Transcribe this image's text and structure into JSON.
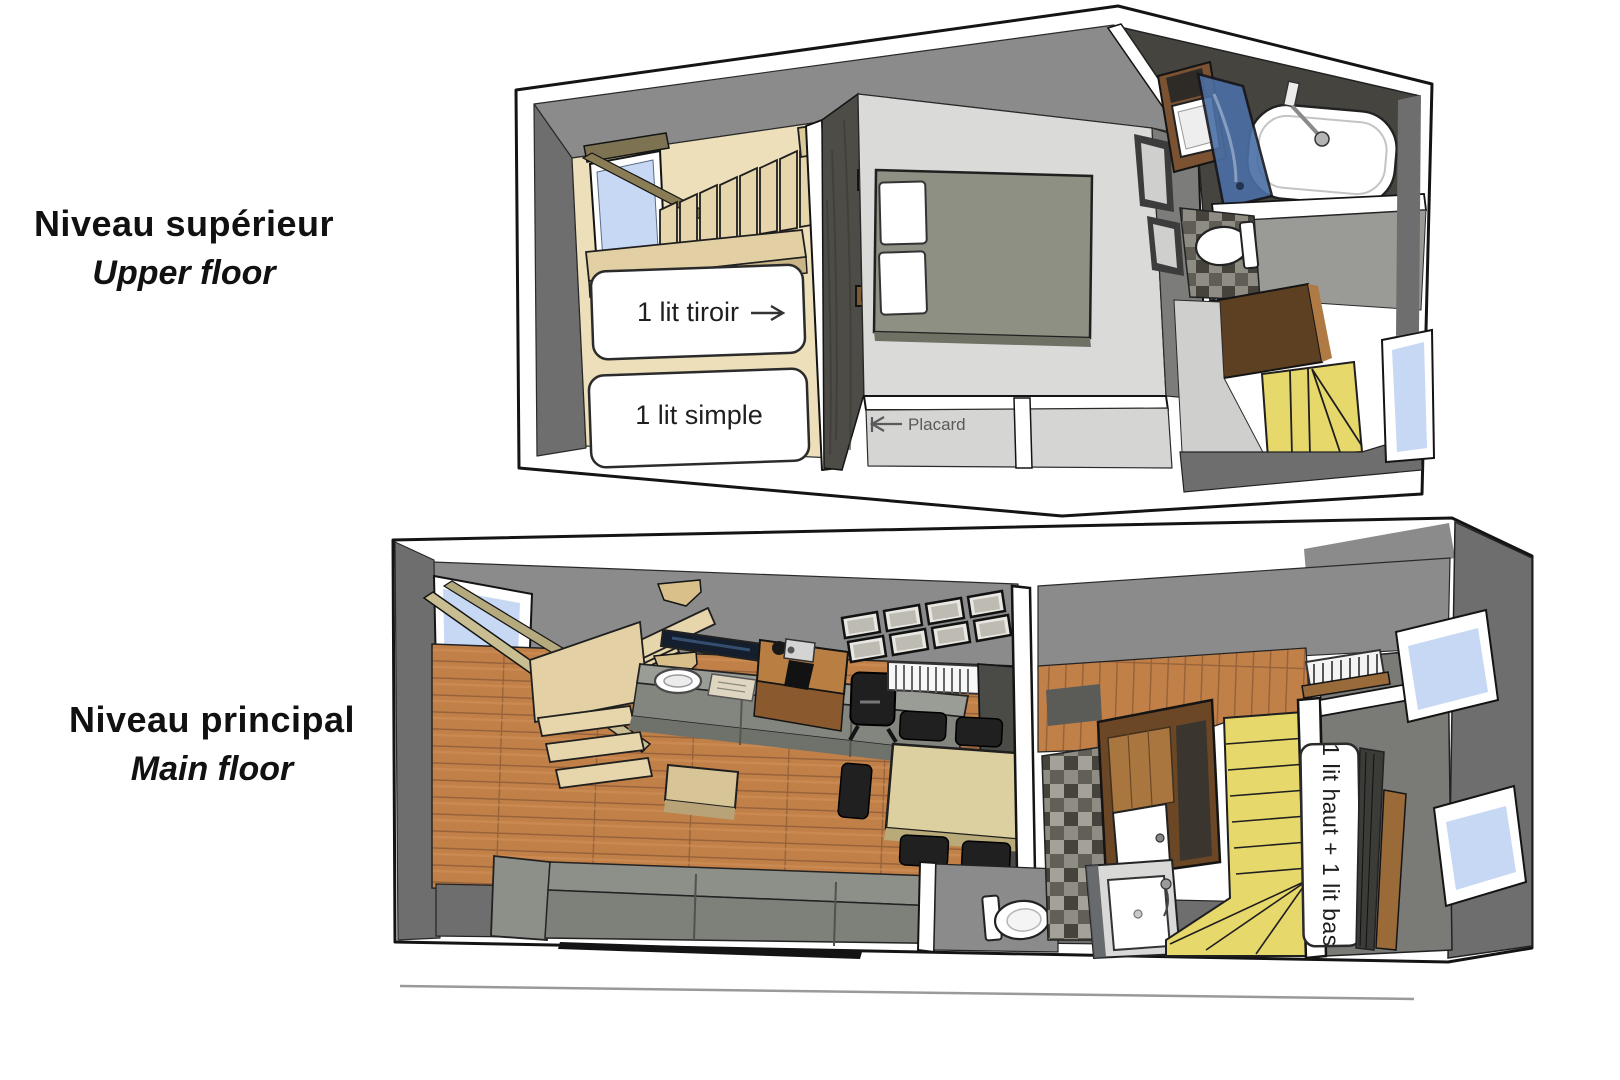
{
  "page": {
    "background_color": "#ffffff"
  },
  "floor_sections": {
    "upper": {
      "title_fr": "Niveau supérieur",
      "title_en": "Upper floor"
    },
    "main": {
      "title_fr": "Niveau principal",
      "title_en": "Main floor"
    }
  },
  "annotations": {
    "bed_drawer": "1 lit tiroir",
    "bed_single": "1 lit simple",
    "closet": "Placard",
    "bunk_beds": "1 lit haut + 1 lit bas"
  },
  "legend_colors": {
    "light_wood": "#e7d6ab",
    "wood_floor": "#c08048",
    "stair_yellow": "#e7d86c",
    "window_blue": "#c7d8f4",
    "glass_blue": "#4a6fa5",
    "wall_gray": "#8b8b8b",
    "wall_dark_gray": "#6e6e6e",
    "bed_gray_green": "#8e9083",
    "outline_black": "#1a1a1a"
  }
}
